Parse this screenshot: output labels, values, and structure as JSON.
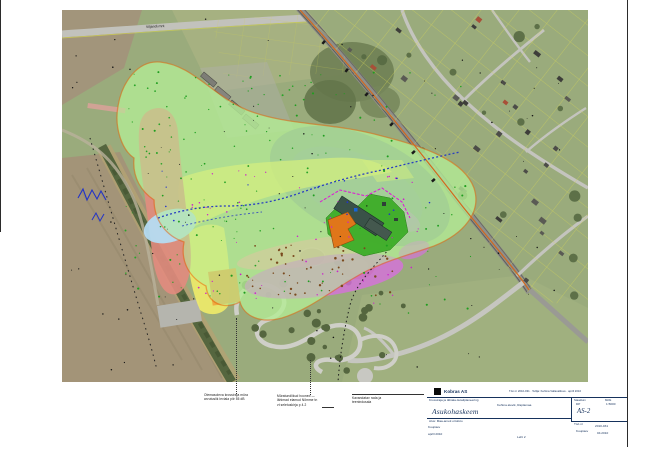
{
  "map": {
    "road_label": "Viljandi mnt",
    "overlay_colors": {
      "noise_contour_green": "#9ce87e",
      "noise_zone_red": "#e28b7e",
      "noise_zone_yellow": "#f4ee68",
      "noise_zone_magenta": "#d96ee0",
      "noise_zone_pink": "#f0a8a2",
      "noise_zone_lightblue": "#b5dcf2",
      "shadow_ellipse_gray": "#73879b",
      "site_boundary_orange": "#e06a10",
      "facility_green": "#3fae2a",
      "facility_building_orange": "#e0761a",
      "fence_magenta": "#e014d8",
      "stream_blue": "#2a3fc0",
      "parcel_line_yellow": "#d8d855"
    }
  },
  "annotations": {
    "note_a": [
      "Olemasoleva krossiraja müra",
      "arvutuslik leviala piir 55 dB"
    ],
    "note_b": [
      "Müratundlikud hooned —",
      "lähimad elamud Nõmme tn",
      "vt seletuskirja p 4.2"
    ],
    "note_c": [
      "Kavandatav rada ja",
      "teenindusala"
    ]
  },
  "titleblock": {
    "company": "Kobras AS",
    "header_right": "Töö nr 2010-031 · Tellija: Kehtna Vallavalitsus · aprill 2010",
    "project_line1": "Krossiraja ja lähiala detailplaneering",
    "project_line2": "Kehtna alevik, Raplamaa",
    "title": "Asukohaskeem",
    "stage_label": "Staadium",
    "stage_value": "DP",
    "scale_label": "Mõõt",
    "scale_value": "1:5000",
    "drawing_no": "AS-2",
    "base_line": "Alus: Maa-ameti ortofoto",
    "date_label": "Kuupäev",
    "date_value": "aprill 2010",
    "worknr_label": "Töö nr",
    "worknr_value": "2010-031",
    "sheet_label": "Kuupäev",
    "sheet_value": "04.2010",
    "footer_center": "Leht 2"
  }
}
